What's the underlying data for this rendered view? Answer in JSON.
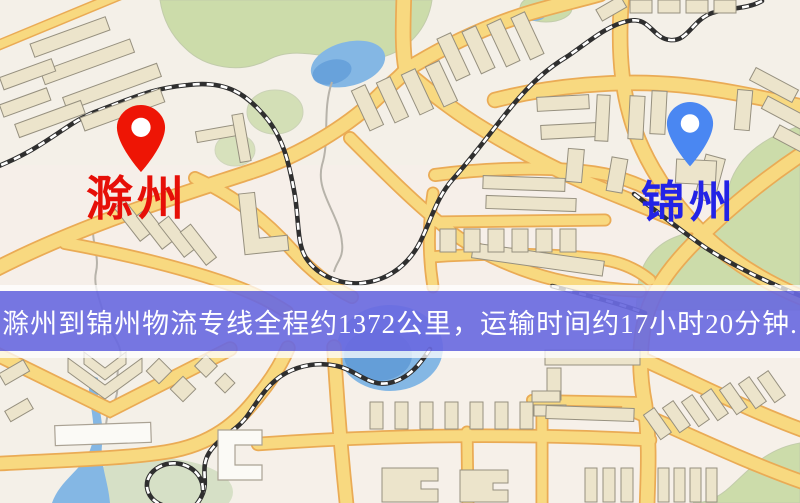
{
  "map": {
    "origin": {
      "name": "滁州",
      "label_color": "#e60f08",
      "pin_color": "#ee1505"
    },
    "destination": {
      "name": "锦州",
      "label_color": "#2323e6",
      "pin_color": "#4a87f2"
    }
  },
  "banner": {
    "text": "滁州到锦州物流专线全程约1372公里，运输时间约17小时20分钟.",
    "text_color": "#ffffff",
    "band_color": "#2828d2",
    "strip_color": "#ffffff"
  },
  "route": {
    "distance_km": "1372",
    "duration_hours": "17",
    "duration_minutes": "20"
  },
  "palette": {
    "background": "#f4f0e8",
    "road_fill": "#f8d980",
    "road_casing": "#eaab55",
    "building_fill": "#ece4cb",
    "building_stroke": "#96907f",
    "green_area": "#ccdcaa",
    "water": "#84b7e4",
    "railway_dark": "#2f2f2f",
    "railway_light": "#ffffff"
  }
}
